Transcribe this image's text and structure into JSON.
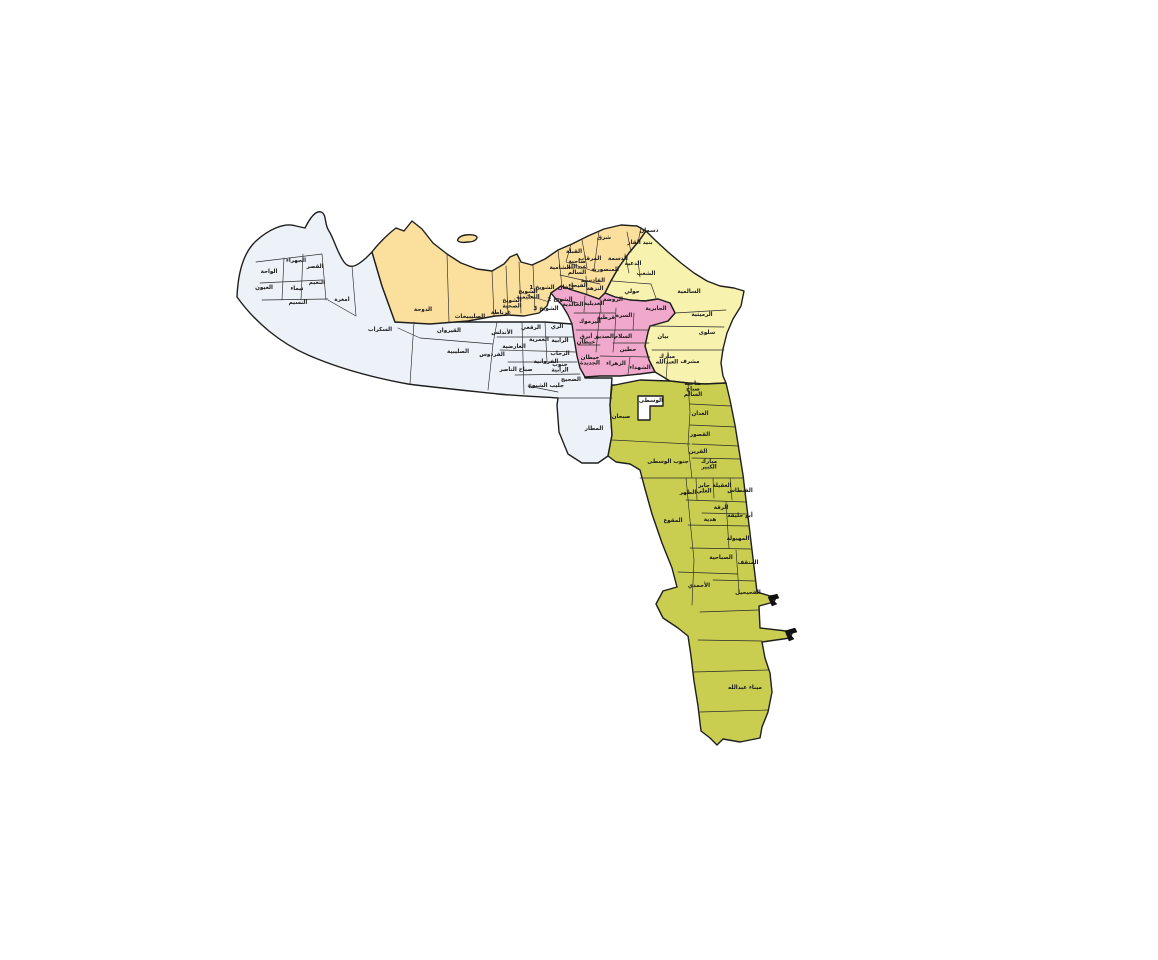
{
  "map": {
    "background_color": "#ffffff",
    "outline_color": "#1f1f1f",
    "regions": [
      {
        "id": "fourth",
        "color": "#edf2f8",
        "districts": [
          {
            "label": "الجهراء",
            "x": 296,
            "y": 262
          },
          {
            "label": "القصر",
            "x": 315,
            "y": 268
          },
          {
            "label": "الواحة",
            "x": 269,
            "y": 273
          },
          {
            "label": "العيون",
            "x": 264,
            "y": 289
          },
          {
            "label": "تيماء",
            "x": 297,
            "y": 290
          },
          {
            "label": "النعيم",
            "x": 317,
            "y": 284
          },
          {
            "label": "النسيم",
            "x": 298,
            "y": 304
          },
          {
            "label": "امغرة",
            "x": 342,
            "y": 301
          },
          {
            "label": "السكراب",
            "x": 380,
            "y": 331
          },
          {
            "label": "القيروان",
            "x": 449,
            "y": 332
          },
          {
            "label": "الصليبية",
            "x": 458,
            "y": 353
          },
          {
            "label": "الأندلس",
            "x": 502,
            "y": 334
          },
          {
            "label": "الرقعي",
            "x": 531,
            "y": 329
          },
          {
            "label": "الري",
            "x": 557,
            "y": 328
          },
          {
            "label": "العارضية",
            "x": 514,
            "y": 348
          },
          {
            "label": "العمرية",
            "x": 539,
            "y": 341
          },
          {
            "label": "الرابية",
            "x": 560,
            "y": 342
          },
          {
            "label": "الرحاب",
            "x": 560,
            "y": 355
          },
          {
            "label": "الفروانية",
            "x": 546,
            "y": 363
          },
          {
            "label": "جنوب\nالرابية",
            "x": 560,
            "y": 366
          },
          {
            "label": "الفردوس",
            "x": 492,
            "y": 356
          },
          {
            "label": "صباح الناصر",
            "x": 516,
            "y": 371
          },
          {
            "label": "جليب الشيوخ",
            "x": 546,
            "y": 387
          },
          {
            "label": "الضجيج",
            "x": 571,
            "y": 381
          },
          {
            "label": "المطار",
            "x": 594,
            "y": 430
          }
        ]
      },
      {
        "id": "second",
        "color": "#fbdf9d",
        "districts": [
          {
            "label": "الدوحة",
            "x": 423,
            "y": 311
          },
          {
            "label": "الصليبيخات",
            "x": 470,
            "y": 318
          },
          {
            "label": "غرناطة",
            "x": 501,
            "y": 314
          },
          {
            "label": "الشويخ\nالصحية",
            "x": 512,
            "y": 302
          },
          {
            "label": "الشويخ\nالتعليمية",
            "x": 528,
            "y": 293
          },
          {
            "label": "الشويخ 1",
            "x": 542,
            "y": 289
          },
          {
            "label": "الشويخ 2",
            "x": 560,
            "y": 301
          },
          {
            "label": "الشويخ 3",
            "x": 546,
            "y": 310
          },
          {
            "label": "القبلة",
            "x": 574,
            "y": 253
          },
          {
            "label": "شرق",
            "x": 604,
            "y": 239
          },
          {
            "label": "المرقاب",
            "x": 590,
            "y": 260
          },
          {
            "label": "ضاحية\nعبدالله\nالسالم",
            "x": 577,
            "y": 263
          },
          {
            "label": "الشامية",
            "x": 560,
            "y": 269
          },
          {
            "label": "القادسية",
            "x": 593,
            "y": 282
          },
          {
            "label": "المنصورية",
            "x": 605,
            "y": 271
          },
          {
            "label": "الفيحاء",
            "x": 578,
            "y": 287
          },
          {
            "label": "النزهة",
            "x": 595,
            "y": 290
          }
        ]
      },
      {
        "id": "first",
        "color": "#f7f2ae",
        "districts": [
          {
            "label": "دسمان",
            "x": 649,
            "y": 232
          },
          {
            "label": "بنيد القار",
            "x": 640,
            "y": 244
          },
          {
            "label": "الدسمة",
            "x": 618,
            "y": 260
          },
          {
            "label": "الدعية",
            "x": 633,
            "y": 265
          },
          {
            "label": "الشعب",
            "x": 646,
            "y": 275
          },
          {
            "label": "حولي",
            "x": 632,
            "y": 293
          },
          {
            "label": "السالمية",
            "x": 689,
            "y": 293
          },
          {
            "label": "الرميثية",
            "x": 702,
            "y": 316
          },
          {
            "label": "سلوى",
            "x": 707,
            "y": 334
          },
          {
            "label": "بيان",
            "x": 663,
            "y": 338
          },
          {
            "label": "مشرف",
            "x": 690,
            "y": 363
          },
          {
            "label": "مبارك\nالعبدالله",
            "x": 667,
            "y": 358
          }
        ]
      },
      {
        "id": "third",
        "color": "#f0a9cc",
        "districts": [
          {
            "label": "كيفان",
            "x": 566,
            "y": 289
          },
          {
            "label": "الخالدية",
            "x": 573,
            "y": 306
          },
          {
            "label": "العديلية",
            "x": 594,
            "y": 305
          },
          {
            "label": "الروضة",
            "x": 613,
            "y": 301
          },
          {
            "label": "الجابرية",
            "x": 656,
            "y": 310
          },
          {
            "label": "قرطبة",
            "x": 606,
            "y": 319
          },
          {
            "label": "السرة",
            "x": 624,
            "y": 317
          },
          {
            "label": "اليرموك",
            "x": 590,
            "y": 323
          },
          {
            "label": "أبرق\nخيطان",
            "x": 586,
            "y": 338
          },
          {
            "label": "خيطان\nالجديدة",
            "x": 590,
            "y": 359
          },
          {
            "label": "الصديق",
            "x": 604,
            "y": 338
          },
          {
            "label": "السلام",
            "x": 623,
            "y": 338
          },
          {
            "label": "حطين",
            "x": 628,
            "y": 351
          },
          {
            "label": "الزهراء",
            "x": 616,
            "y": 365
          },
          {
            "label": "الشهداء",
            "x": 640,
            "y": 369
          }
        ]
      },
      {
        "id": "fifth",
        "color": "#c9cd50",
        "districts": [
          {
            "label": "الوسطى",
            "x": 651,
            "y": 402
          },
          {
            "label": "صبحان",
            "x": 621,
            "y": 418
          },
          {
            "label": "جنوب الوسطى",
            "x": 668,
            "y": 463
          },
          {
            "label": "ضاحية\nصباح\nالسالم",
            "x": 693,
            "y": 385
          },
          {
            "label": "العدان",
            "x": 700,
            "y": 415
          },
          {
            "label": "القصور",
            "x": 700,
            "y": 436
          },
          {
            "label": "القرين",
            "x": 698,
            "y": 453
          },
          {
            "label": "مبارك\nالكبير",
            "x": 709,
            "y": 463
          },
          {
            "label": "الظهر",
            "x": 688,
            "y": 494
          },
          {
            "label": "جابر\nالعلي",
            "x": 704,
            "y": 487
          },
          {
            "label": "العقيلة",
            "x": 722,
            "y": 487
          },
          {
            "label": "الفنطاس",
            "x": 740,
            "y": 492
          },
          {
            "label": "الرقة",
            "x": 721,
            "y": 509
          },
          {
            "label": "هدية",
            "x": 710,
            "y": 521
          },
          {
            "label": "أبو حليفة",
            "x": 740,
            "y": 517
          },
          {
            "label": "المهبولة",
            "x": 738,
            "y": 540
          },
          {
            "label": "الصباحية",
            "x": 721,
            "y": 559
          },
          {
            "label": "المنقف",
            "x": 748,
            "y": 564
          },
          {
            "label": "الأحمدي",
            "x": 699,
            "y": 587
          },
          {
            "label": "الفحيحيل",
            "x": 748,
            "y": 594
          },
          {
            "label": "المقوع",
            "x": 673,
            "y": 522
          },
          {
            "label": "ميناء عبدالله",
            "x": 745,
            "y": 689
          }
        ]
      }
    ]
  }
}
